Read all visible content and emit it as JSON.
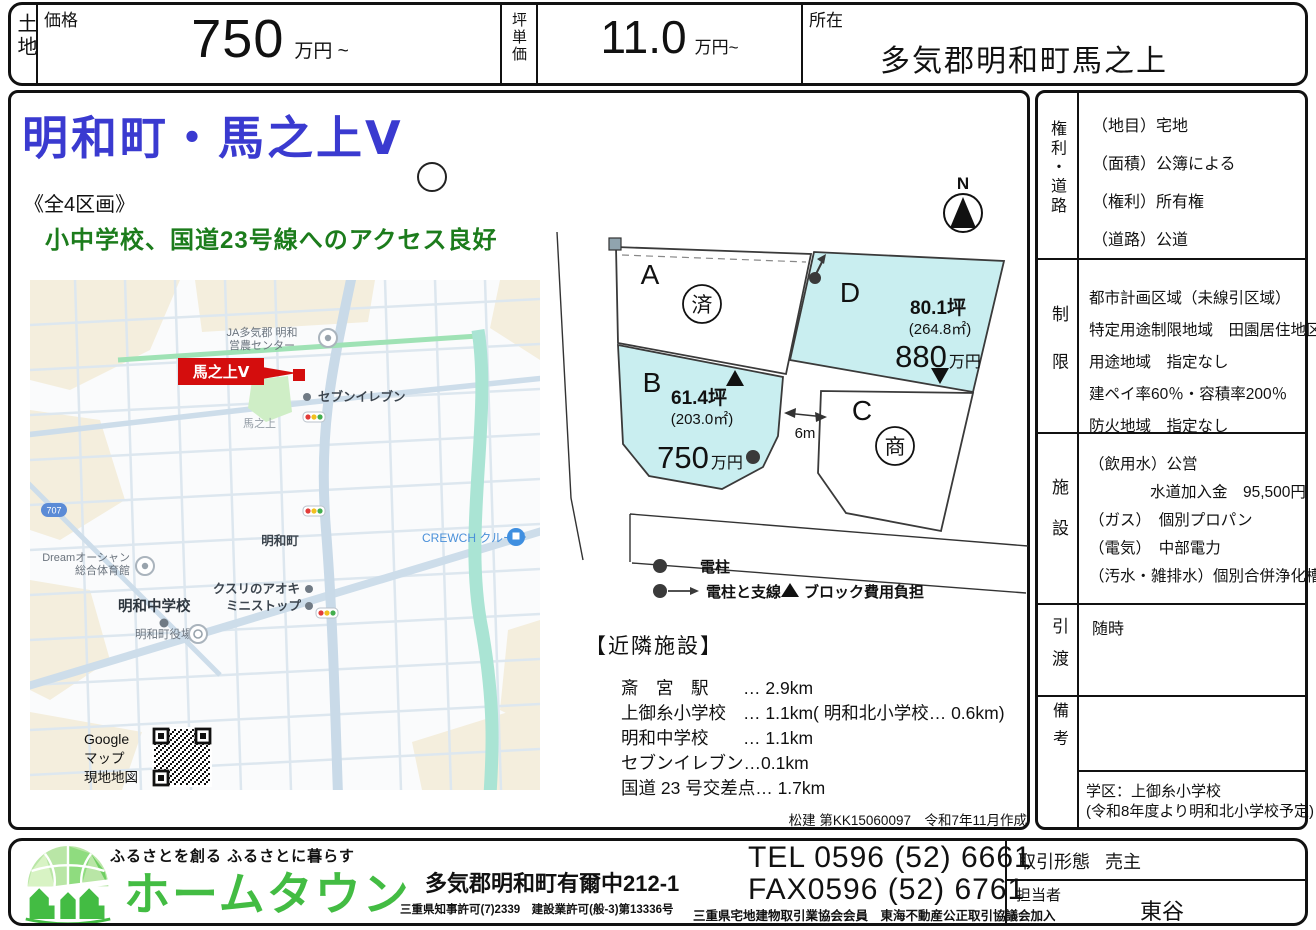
{
  "header": {
    "category": "土地",
    "price_label": "価格",
    "price_value": "750",
    "price_unit": "万円 ~",
    "tsubo_label": "坪単価",
    "tsubo_value": "11.0",
    "tsubo_unit": "万円~",
    "location_label": "所在",
    "location_value": "多気郡明和町馬之上"
  },
  "main": {
    "title": "明和町・馬之上Ⅴ",
    "subtitle": "《全4区画》",
    "catchcopy": "小中学校、国道23号線へのアクセス良好",
    "map": {
      "google_note_1": "Google",
      "google_note_2": "マップ",
      "google_note_3": "現地地図",
      "labels": {
        "ja_center_1": "JA多気郡 明和",
        "ja_center_2": "営農センター",
        "site": "馬之上Ⅴ",
        "seven_eleven": "セブンイレブン",
        "banojo": "馬之上",
        "route_badge": "707",
        "meiwa_cho": "明和町",
        "crewch": "CREWCH クルーチ",
        "dream_1": "Dreamオーシャン",
        "dream_2": "総合体育館",
        "junior_high": "明和中学校",
        "town_hall": "明和町役場",
        "kusuri_aoki": "クスリのアオキ",
        "ministop": "ミニストップ"
      }
    },
    "plot": {
      "compass": "N",
      "road_width": "6m",
      "lots": [
        {
          "id": "A",
          "status": "済"
        },
        {
          "id": "B",
          "tsubo": "61.4坪",
          "area": "(203.0㎡)",
          "price": "750",
          "price_unit": "万円"
        },
        {
          "id": "C",
          "status": "商"
        },
        {
          "id": "D",
          "tsubo": "80.1坪",
          "area": "(264.8㎡)",
          "price": "880",
          "price_unit": "万円"
        }
      ],
      "legend": [
        {
          "label": "電柱"
        },
        {
          "label": "電柱と支線"
        },
        {
          "label": "ブロック費用負担"
        }
      ]
    },
    "facilities": {
      "title": "【近隣施設】",
      "rows": [
        {
          "name": "斎　宮　駅",
          "distance": "… 2.9km"
        },
        {
          "name": "上御糸小学校",
          "distance": "… 1.1km( 明和北小学校… 0.6km)"
        },
        {
          "name": "明和中学校",
          "distance": "… 1.1km"
        },
        {
          "name": "セブンイレブン",
          "distance": "…0.1km"
        },
        {
          "name": "国道 23 号交差点",
          "distance": "… 1.7km"
        }
      ],
      "note": "松建 第KK15060097　令和7年11月作成"
    }
  },
  "sidebar": {
    "sections": [
      {
        "label": "権利・道路",
        "lines": [
          "（地目）宅地",
          "（面積）公簿による",
          "（権利）所有権",
          "（道路）公道"
        ]
      },
      {
        "label": "制限",
        "lines": [
          "都市計画区域（未線引区域）",
          "特定用途制限地域　田園居住地区",
          "用途地域　指定なし",
          "建ペイ率60％・容積率200％",
          "防火地域　指定なし"
        ]
      },
      {
        "label": "施設",
        "lines": [
          "（飲用水）公営",
          "水道加入金　95,500円",
          "（ガス）　個別プロパン",
          "（電気）　中部電力",
          "（汚水・雑排水）個別合併浄化槽"
        ]
      },
      {
        "label": "引渡",
        "lines": [
          "随時"
        ]
      },
      {
        "label": "備考",
        "lines": []
      }
    ],
    "school_note_1": "学区：上御糸小学校",
    "school_note_2": "(令和8年度より明和北小学校予定)"
  },
  "footer": {
    "slogan": "ふるさとを創る ふるさとに暮らす",
    "company": "ホームタウン",
    "address": "多気郡明和町有爾中212-1",
    "license": "三重県知事許可(7)2339　建設業許可(般-3)第13336号",
    "tel": "TEL 0596 (52) 6661",
    "fax": "FAX0596 (52) 6761",
    "membership": "三重県宅地建物取引業協会会員　東海不動産公正取引協議会加入",
    "deal_type_label": "取引形態",
    "deal_type": "売主",
    "agent_label": "担当者",
    "agent": "東谷"
  },
  "colors": {
    "title_blue": "#3a3ad0",
    "catch_green": "#1c7c1c",
    "lot_highlight_cyan": "#c9eef0",
    "site_red": "#d40d0d",
    "brand_green": "#43bc43"
  }
}
